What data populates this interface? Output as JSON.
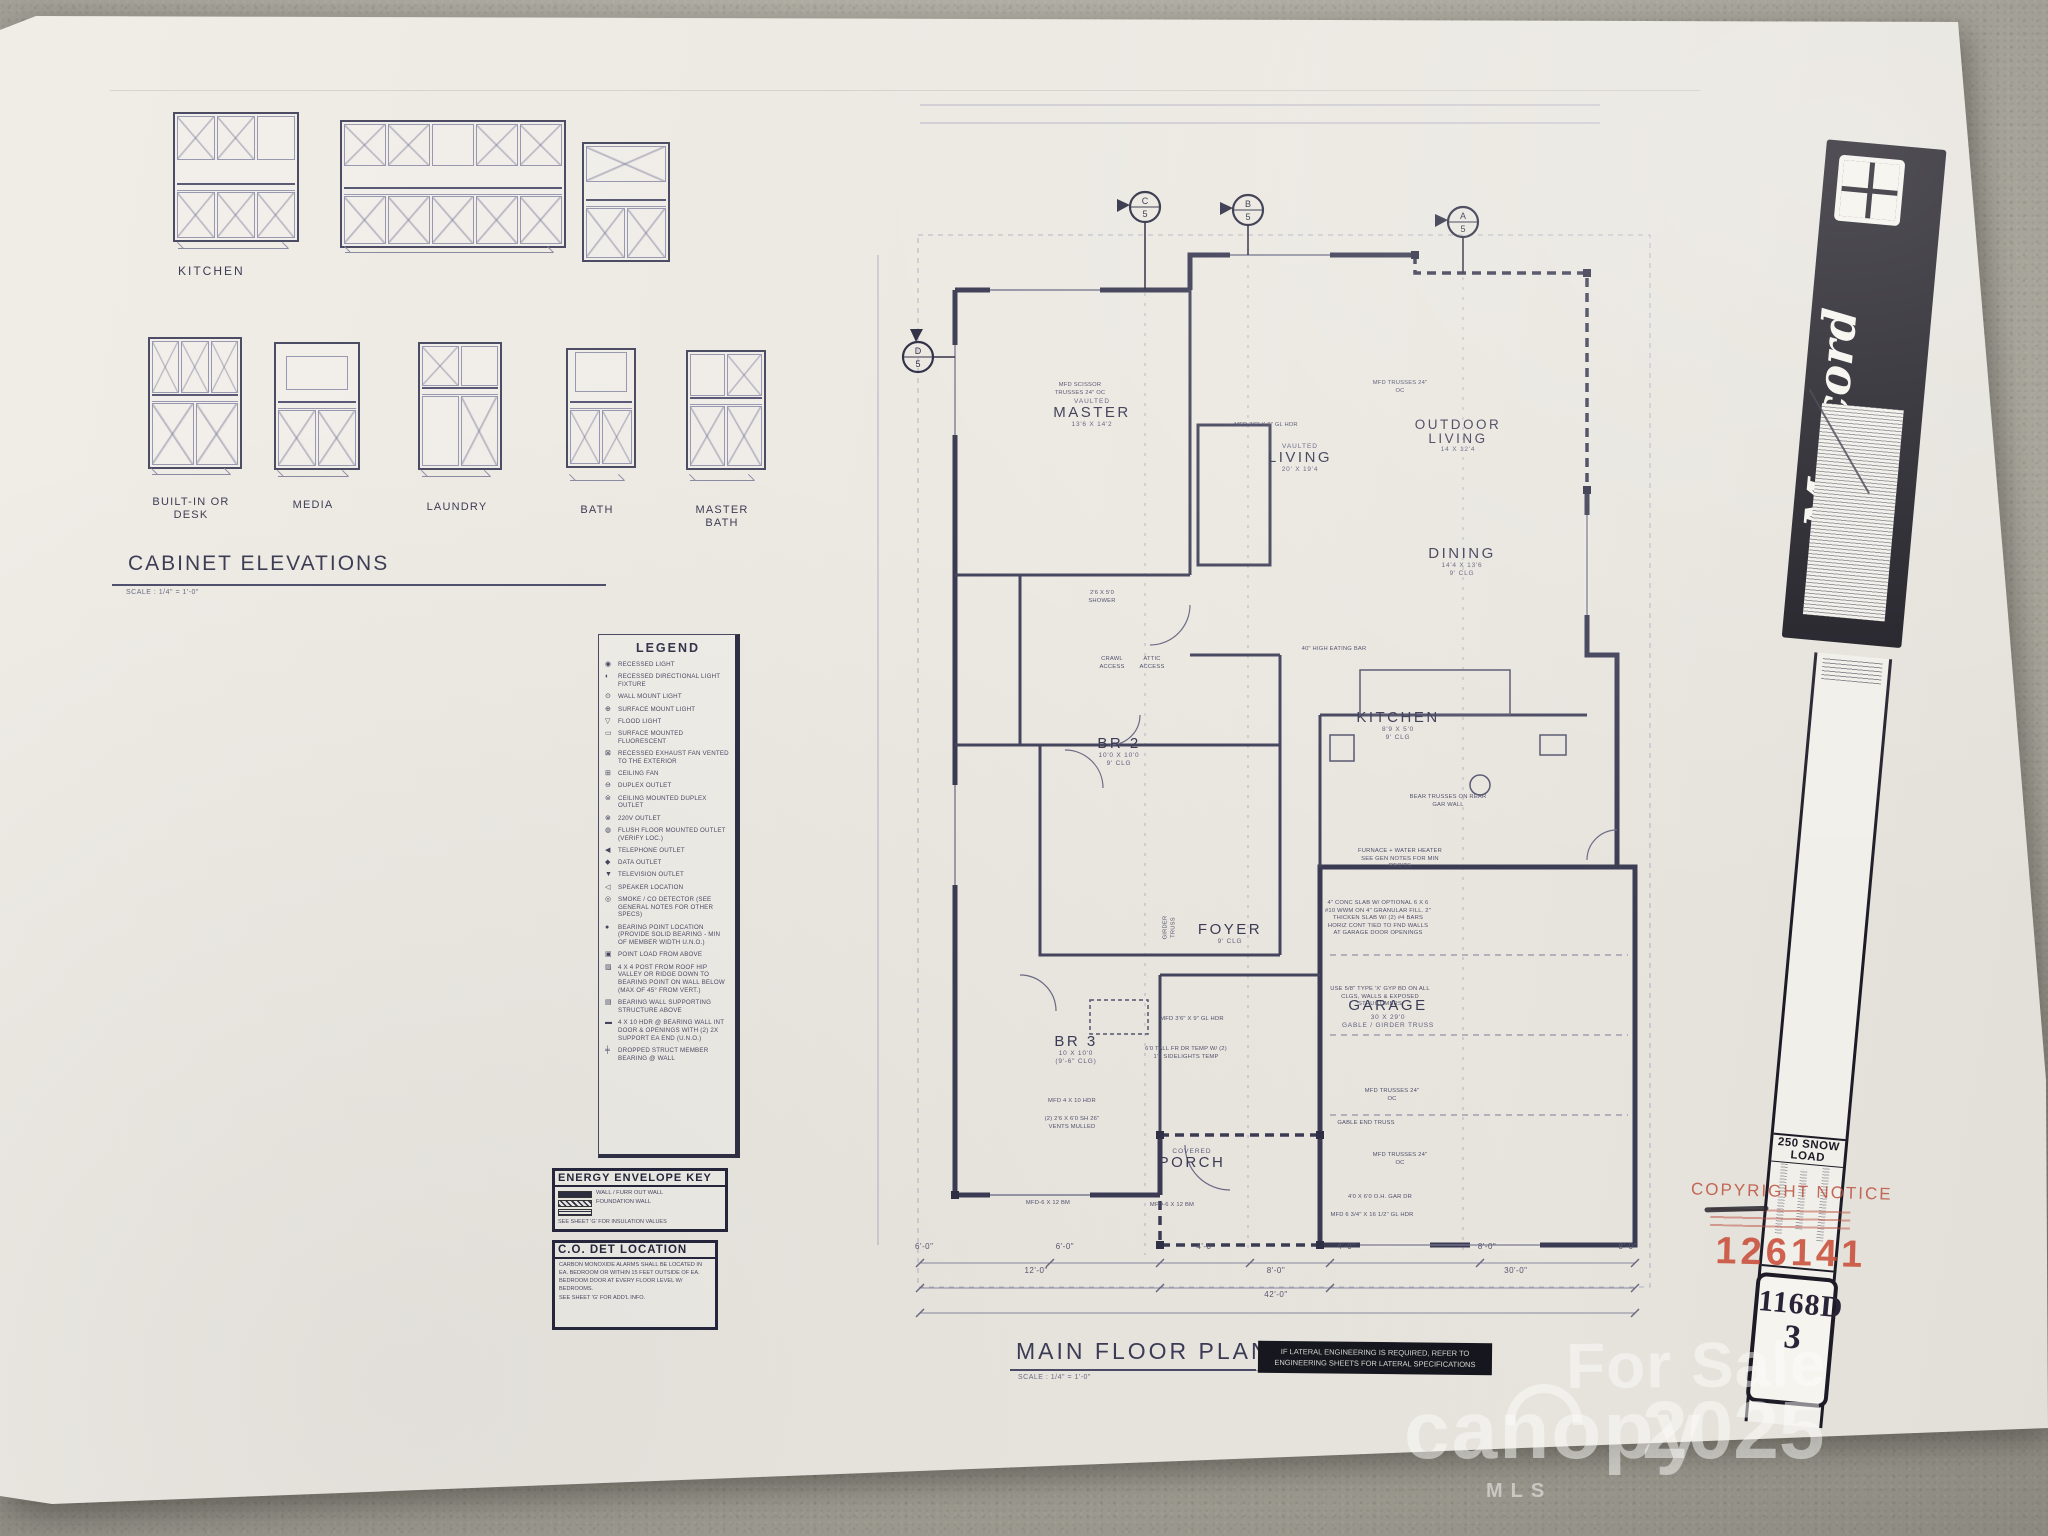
{
  "cabinet_elevations": {
    "title": "CABINET ELEVATIONS",
    "scale": "SCALE : 1/4\" = 1'-0\"",
    "kitchen_label": "KITCHEN",
    "row2_labels": [
      "BUILT-IN OR DESK",
      "MEDIA",
      "LAUNDRY",
      "BATH",
      "MASTER BATH"
    ]
  },
  "legend": {
    "title": "LEGEND",
    "items": [
      {
        "glyph": "◉",
        "label": "RECESSED LIGHT"
      },
      {
        "glyph": "◐",
        "label": "RECESSED DIRECTIONAL LIGHT FIXTURE"
      },
      {
        "glyph": "⊙",
        "label": "WALL MOUNT LIGHT"
      },
      {
        "glyph": "⊕",
        "label": "SURFACE MOUNT LIGHT"
      },
      {
        "glyph": "▽",
        "label": "FLOOD LIGHT"
      },
      {
        "glyph": "▭",
        "label": "SURFACE MOUNTED FLUORESCENT"
      },
      {
        "glyph": "⊠",
        "label": "RECESSED EXHAUST FAN VENTED TO THE EXTERIOR"
      },
      {
        "glyph": "⊞",
        "label": "CEILING FAN"
      },
      {
        "glyph": "⊖",
        "label": "DUPLEX OUTLET"
      },
      {
        "glyph": "⊜",
        "label": "CEILING MOUNTED DUPLEX OUTLET"
      },
      {
        "glyph": "⊗",
        "label": "220V OUTLET"
      },
      {
        "glyph": "◍",
        "label": "FLUSH FLOOR MOUNTED OUTLET (VERIFY LOC.)"
      },
      {
        "glyph": "◀",
        "label": "TELEPHONE OUTLET"
      },
      {
        "glyph": "◆",
        "label": "DATA OUTLET"
      },
      {
        "glyph": "▼",
        "label": "TELEVISION OUTLET"
      },
      {
        "glyph": "◁",
        "label": "SPEAKER LOCATION"
      },
      {
        "glyph": "◎",
        "label": "SMOKE / CO DETECTOR (SEE GENERAL NOTES FOR OTHER SPECS)"
      },
      {
        "glyph": "●",
        "label": "BEARING POINT LOCATION (PROVIDE SOLID BEARING - MIN OF MEMBER WIDTH U.N.O.)"
      },
      {
        "glyph": "▣",
        "label": "POINT LOAD FROM ABOVE"
      },
      {
        "glyph": "▨",
        "label": "4 X 4 POST FROM ROOF HIP VALLEY OR RIDGE DOWN TO BEARING POINT ON WALL BELOW (MAX OF 45° FROM VERT.)"
      },
      {
        "glyph": "▤",
        "label": "BEARING WALL SUPPORTING STRUCTURE ABOVE"
      },
      {
        "glyph": "▬",
        "label": "4 X 10 HDR @ BEARING WALL INT DOOR & OPENINGS WITH (2) 2X SUPPORT EA END (U.N.O.)"
      },
      {
        "glyph": "╪",
        "label": "DROPPED STRUCT MEMBER BEARING @ WALL"
      }
    ]
  },
  "energy_envelope_key": {
    "title": "ENERGY ENVELOPE KEY",
    "lines": [
      "WALL / FURR OUT WALL",
      "FOUNDATION WALL"
    ],
    "note": "SEE SHEET 'G' FOR INSULATION VALUES"
  },
  "co_det_location": {
    "title": "C.O. DET LOCATION",
    "body": "CARBON MONOXIDE ALARMS SHALL BE LOCATED IN EA. BEDROOM OR WITHIN 15 FEET OUTSIDE OF EA. BEDROOM DOOR AT EVERY FLOOR LEVEL W/ BEDROOMS.",
    "note": "SEE SHEET 'G' FOR ADD'L INFO."
  },
  "floor_plan": {
    "title": "MAIN FLOOR PLAN",
    "scale": "SCALE : 1/4\" = 1'-0\"",
    "lateral_note": "IF LATERAL ENGINEERING IS REQUIRED, REFER TO ENGINEERING SHEETS FOR LATERAL SPECIFICATIONS",
    "grid_bubbles": [
      {
        "letter": "C",
        "number": "5"
      },
      {
        "letter": "B",
        "number": "5"
      },
      {
        "letter": "A",
        "number": "5"
      },
      {
        "letter": "D",
        "number": "5"
      }
    ],
    "rooms": [
      {
        "vault": "VAULTED",
        "name": "MASTER",
        "size": "13'6 X 14'2"
      },
      {
        "vault": "VAULTED",
        "name": "LIVING",
        "size": "20' X 19'4"
      },
      {
        "name": "OUTDOOR LIVING",
        "size": "14 X 12'4"
      },
      {
        "name": "DINING",
        "size": "14'4 X 13'6",
        "clg": "9' CLG"
      },
      {
        "name": "KITCHEN",
        "size": "8'9 X 5'0",
        "clg": "9' CLG"
      },
      {
        "name": "BR 2",
        "size": "10'0 X 10'0",
        "clg": "9' CLG"
      },
      {
        "name": "FOYER",
        "clg": "9' CLG"
      },
      {
        "name": "BR 3",
        "size": "10 X 10'0",
        "clg": "(9'-6\" CLG)"
      },
      {
        "name": "GARAGE",
        "size": "30 X 29'0",
        "note": "GABLE / GIRDER TRUSS"
      },
      {
        "pre": "COVERED",
        "name": "PORCH"
      }
    ],
    "annotations": [
      "MFD SCISSOR TRUSSES 24\" OC",
      "MFD TRUSSES 24\" OC",
      "MFD 3'6\" X 9\" GL HDR",
      "40\" HIGH EATING BAR",
      "FURNACE + WATER HEATER SEE GEN NOTES FOR MIN REQ'TS",
      "BEAR TRUSSES ON REAR GAR WALL",
      "4\" CONC SLAB W/ OPTIONAL 6 X 6 #10 WWM ON 4\" GRANULAR FILL. 2\" THICKEN SLAB W/ (2) #4 BARS HORIZ CONT TIED TO FND WALLS AT GARAGE DOOR OPENINGS",
      "USE 5/8\" TYPE 'X' GYP BD ON ALL CLGS, WALLS & EXPOSED STRUCT MBRS",
      "MFD TRUSSES 24\" OC",
      "GABLE END TRUSS",
      "MFD TRUSSES 24\" OC",
      "4'0 X 6'0 O.H. GAR DR",
      "MFD 6 3/4\" X 16 1/2\" GL HDR",
      "MFD 4 X 10 HDR",
      "(2) 2'6 X 6'0 SH 26\" VENTS MULLED",
      "6'0 TALL FR DR TEMP W/ (2) 1'0 SIDELIGHTS TEMP",
      "MFD 3'6\" X 9\" GL HDR",
      "MFD-6 X 12 BM",
      "MFD-6 X 12 BM",
      "CRAWL ACCESS",
      "ATTIC ACCESS",
      "GIRDER TRUSS",
      "2'6 X 5'0 SHOWER"
    ],
    "dims_row1": [
      "6'-0\"",
      "6'-0\"",
      "4'-0\"",
      "4'-0\"",
      "8'-0\"",
      "8'-0\""
    ],
    "dims_row2": [
      "12'-0\"",
      "8'-0\"",
      "30'-0\""
    ],
    "dims_row3": [
      "42'-0\""
    ]
  },
  "brand": {
    "name": "Mascord",
    "collection": "COLLECTION",
    "snow_load": "250 SNOW LOAD",
    "sheet_number": "1168D",
    "page_number": "3"
  },
  "copyright": {
    "title": "COPYRIGHT NOTICE",
    "plan_number": "126141"
  },
  "watermark": {
    "status": "For Sale",
    "brand": "canopy",
    "brand_sub": "MLS",
    "year": "2025"
  }
}
